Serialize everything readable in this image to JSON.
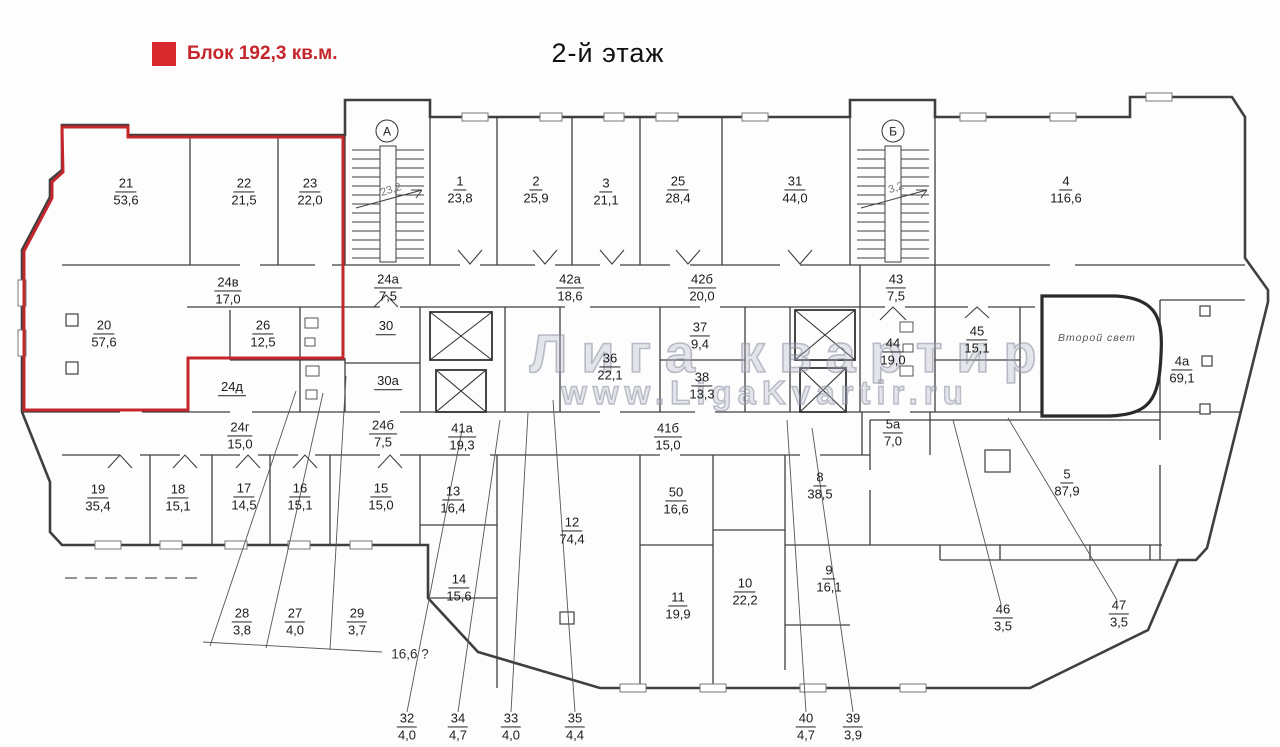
{
  "page": {
    "title": "2-й этаж"
  },
  "legend": {
    "label": "Блок 192,3 кв.м.",
    "block_area_sqm": "192,3",
    "swatch_color": "#d8292f",
    "text_color": "#c4262c"
  },
  "watermark": {
    "line1": "Лига квартир",
    "line2": "www.LigaKvartir.ru"
  },
  "highlight": {
    "color": "#c4262c",
    "rooms_inside": [
      "21",
      "22",
      "23",
      "20",
      "24в",
      "26"
    ]
  },
  "stairwells": [
    {
      "letter": "А",
      "note": "23,2",
      "x": 387,
      "y": 131
    },
    {
      "letter": "Б",
      "note": "3,2",
      "x": 893,
      "y": 131
    }
  ],
  "annotations": {
    "atrium": "Второй свет",
    "unclear_area": "16,6 ?"
  },
  "rooms": [
    {
      "number": "21",
      "area": "53,6",
      "x": 126,
      "y": 192
    },
    {
      "number": "22",
      "area": "21,5",
      "x": 244,
      "y": 192
    },
    {
      "number": "23",
      "area": "22,0",
      "x": 310,
      "y": 192
    },
    {
      "number": "1",
      "area": "23,8",
      "x": 460,
      "y": 190
    },
    {
      "number": "2",
      "area": "25,9",
      "x": 536,
      "y": 190
    },
    {
      "number": "3",
      "area": "21,1",
      "x": 606,
      "y": 192
    },
    {
      "number": "25",
      "area": "28,4",
      "x": 678,
      "y": 190
    },
    {
      "number": "31",
      "area": "44,0",
      "x": 795,
      "y": 190
    },
    {
      "number": "4",
      "area": "116,6",
      "x": 1066,
      "y": 190
    },
    {
      "number": "24а",
      "area": "7,5",
      "x": 388,
      "y": 288
    },
    {
      "number": "42а",
      "area": "18,6",
      "x": 570,
      "y": 288
    },
    {
      "number": "42б",
      "area": "20,0",
      "x": 702,
      "y": 288
    },
    {
      "number": "43",
      "area": "7,5",
      "x": 896,
      "y": 288
    },
    {
      "number": "20",
      "area": "57,6",
      "x": 104,
      "y": 334
    },
    {
      "number": "24в",
      "area": "17,0",
      "x": 228,
      "y": 291
    },
    {
      "number": "26",
      "area": "12,5",
      "x": 263,
      "y": 334
    },
    {
      "number": "24д",
      "area": "",
      "x": 232,
      "y": 388
    },
    {
      "number": "30",
      "area": "",
      "x": 386,
      "y": 327
    },
    {
      "number": "30а",
      "area": "",
      "x": 388,
      "y": 382
    },
    {
      "number": "36",
      "area": "22,1",
      "x": 610,
      "y": 367
    },
    {
      "number": "37",
      "area": "9,4",
      "x": 700,
      "y": 336
    },
    {
      "number": "38",
      "area": "13,3",
      "x": 702,
      "y": 386
    },
    {
      "number": "44",
      "area": "19,0",
      "x": 893,
      "y": 352
    },
    {
      "number": "45",
      "area": "15,1",
      "x": 977,
      "y": 340
    },
    {
      "number": "4а",
      "area": "69,1",
      "x": 1182,
      "y": 370
    },
    {
      "number": "24г",
      "area": "15,0",
      "x": 240,
      "y": 436
    },
    {
      "number": "24б",
      "area": "7,5",
      "x": 383,
      "y": 434
    },
    {
      "number": "41а",
      "area": "19,3",
      "x": 462,
      "y": 437
    },
    {
      "number": "41б",
      "area": "15,0",
      "x": 668,
      "y": 437
    },
    {
      "number": "5а",
      "area": "7,0",
      "x": 893,
      "y": 433
    },
    {
      "number": "19",
      "area": "35,4",
      "x": 98,
      "y": 498
    },
    {
      "number": "18",
      "area": "15,1",
      "x": 178,
      "y": 498
    },
    {
      "number": "17",
      "area": "14,5",
      "x": 244,
      "y": 497
    },
    {
      "number": "16",
      "area": "15,1",
      "x": 300,
      "y": 497
    },
    {
      "number": "15",
      "area": "15,0",
      "x": 381,
      "y": 497
    },
    {
      "number": "13",
      "area": "16,4",
      "x": 453,
      "y": 500
    },
    {
      "number": "14",
      "area": "15,6",
      "x": 459,
      "y": 588
    },
    {
      "number": "12",
      "area": "74,4",
      "x": 572,
      "y": 531
    },
    {
      "number": "50",
      "area": "16,6",
      "x": 676,
      "y": 501
    },
    {
      "number": "11",
      "area": "19,9",
      "x": 678,
      "y": 606
    },
    {
      "number": "10",
      "area": "22,2",
      "x": 745,
      "y": 592
    },
    {
      "number": "8",
      "area": "38,5",
      "x": 820,
      "y": 486
    },
    {
      "number": "9",
      "area": "16,1",
      "x": 829,
      "y": 579
    },
    {
      "number": "5",
      "area": "87,9",
      "x": 1067,
      "y": 483
    },
    {
      "number": "46",
      "area": "3,5",
      "x": 1003,
      "y": 618
    },
    {
      "number": "47",
      "area": "3,5",
      "x": 1119,
      "y": 614
    },
    {
      "number": "28",
      "area": "3,8",
      "x": 242,
      "y": 622
    },
    {
      "number": "27",
      "area": "4,0",
      "x": 295,
      "y": 622
    },
    {
      "number": "29",
      "area": "3,7",
      "x": 357,
      "y": 622
    },
    {
      "number": "32",
      "area": "4,0",
      "x": 407,
      "y": 727
    },
    {
      "number": "34",
      "area": "4,7",
      "x": 458,
      "y": 727
    },
    {
      "number": "33",
      "area": "4,0",
      "x": 511,
      "y": 727
    },
    {
      "number": "35",
      "area": "4,4",
      "x": 575,
      "y": 727
    },
    {
      "number": "40",
      "area": "4,7",
      "x": 806,
      "y": 727
    },
    {
      "number": "39",
      "area": "3,9",
      "x": 853,
      "y": 727
    }
  ]
}
